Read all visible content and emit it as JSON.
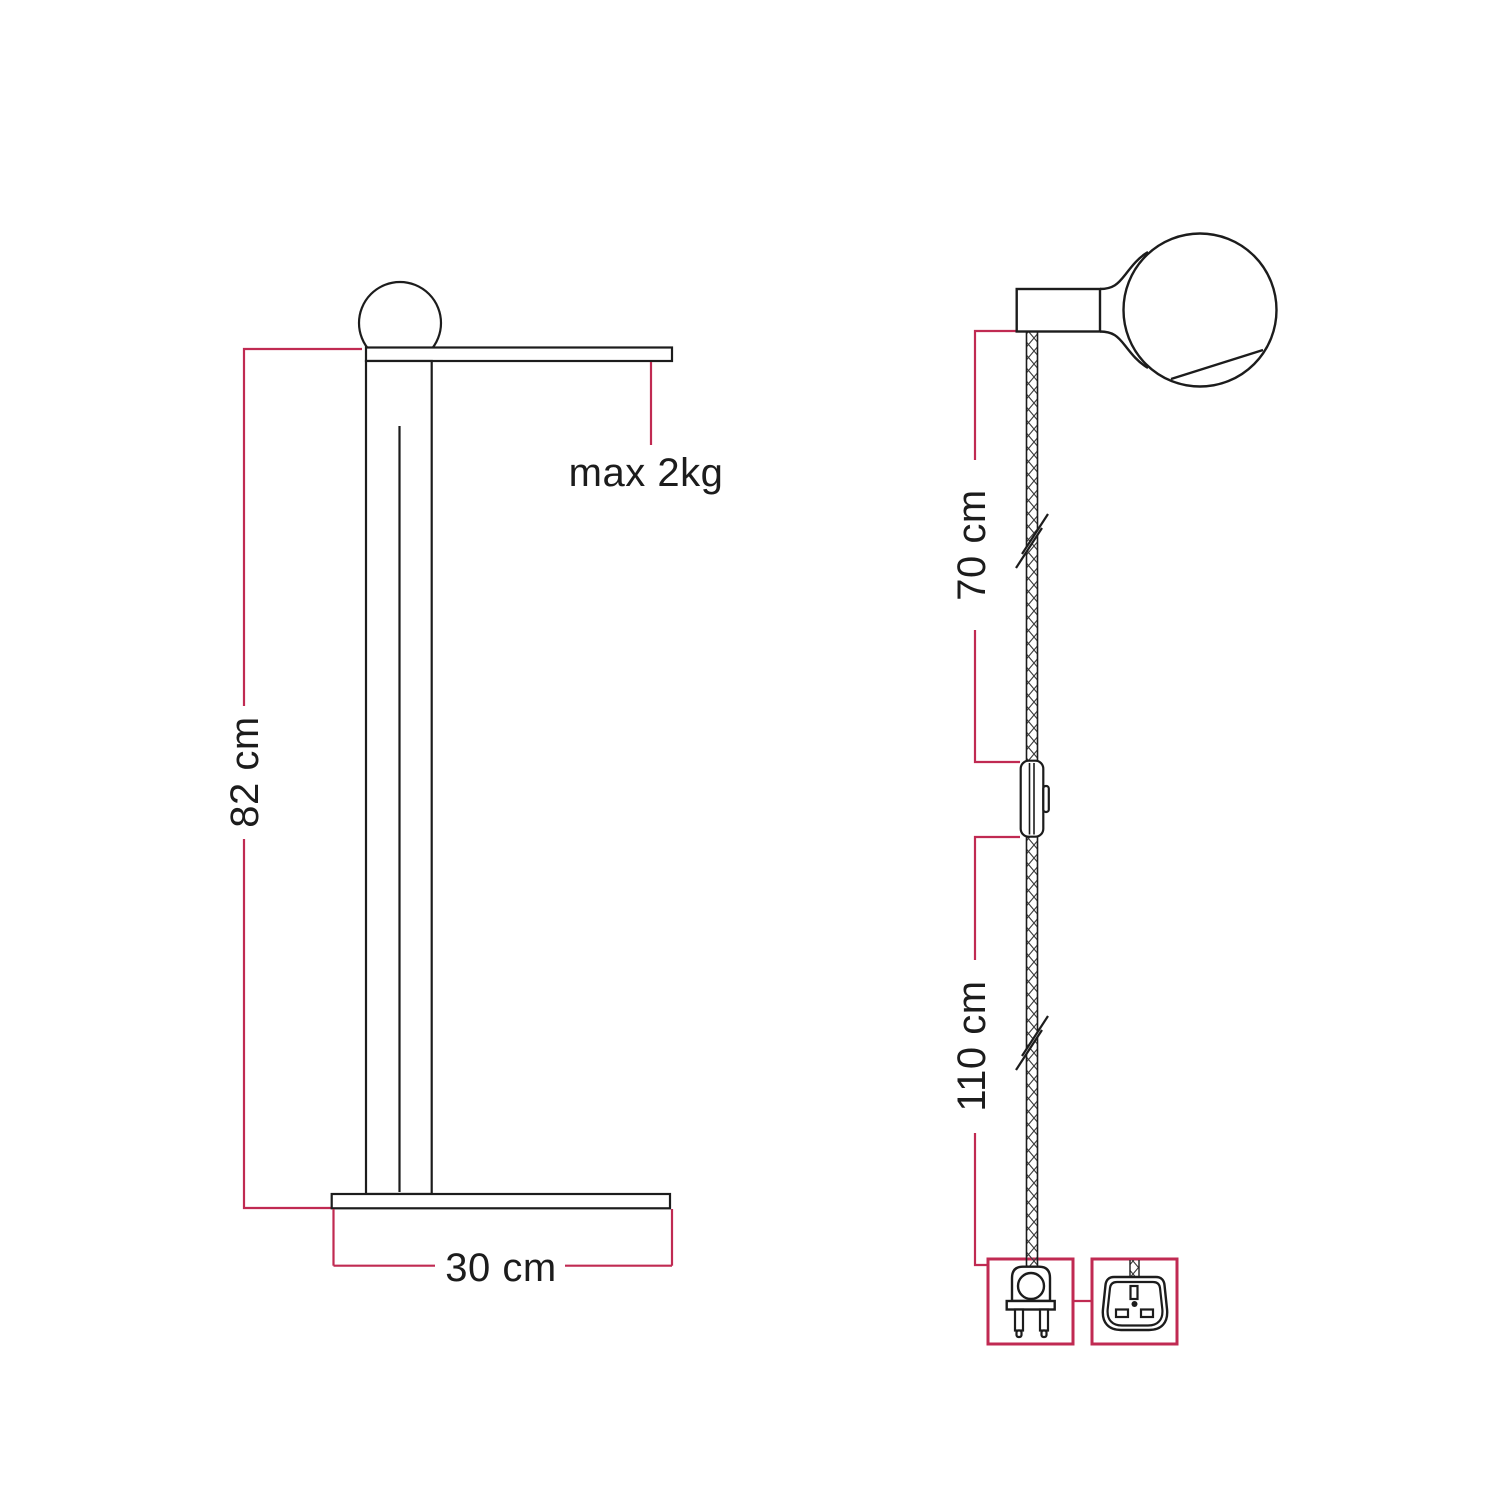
{
  "diagram": {
    "title": "lamp-dimensions-diagram",
    "colors": {
      "dimension_accent": "#C02A52",
      "outline": "#1C1C1C",
      "background": "#FFFFFF"
    },
    "left_figure": {
      "name": "table-lamp-side-view",
      "height_label": "82 cm",
      "base_width_label": "30 cm",
      "max_load_label": "max 2kg"
    },
    "right_figure": {
      "name": "pendant-cable-with-bulb",
      "upper_cable_label": "70 cm",
      "lower_cable_label": "110 cm",
      "icons": {
        "plug": "euro-two-pin-plug-icon",
        "adapter": "uk-three-pin-plug-icon",
        "switch": "inline-switch-icon",
        "bulb": "globe-bulb-icon"
      }
    }
  }
}
